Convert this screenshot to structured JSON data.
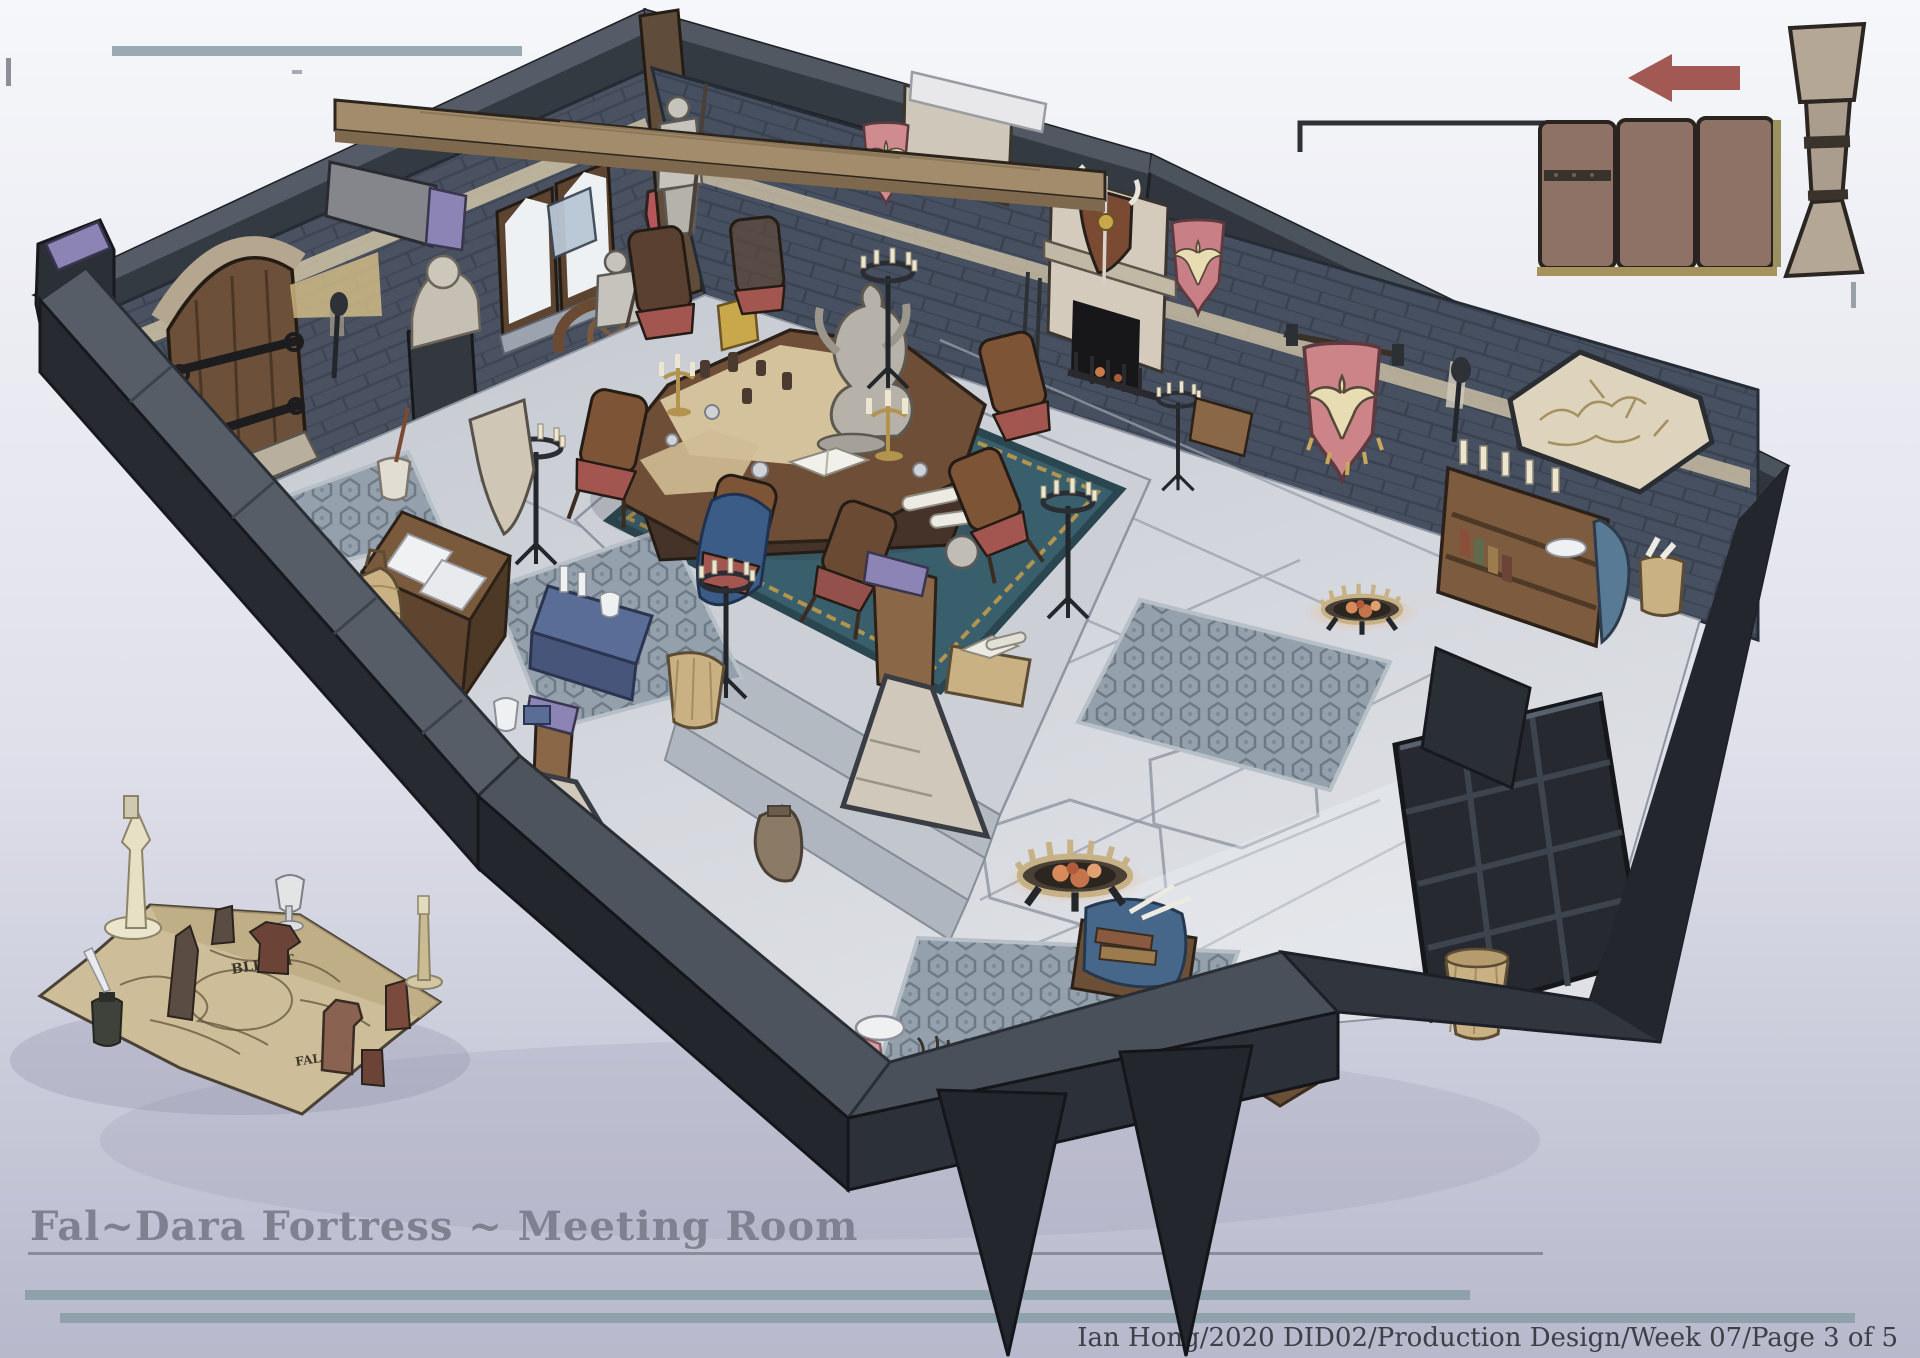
{
  "artwork": {
    "title": "Fal~Dara Fortress ~ Meeting Room",
    "credit": "Ian Hong/2020 DID02/Production Design/Week 07/Page 3 of 5",
    "map_labels": {
      "region": "BLIGHT",
      "fortress": "FAL"
    }
  },
  "palette": {
    "background_top": "#f6f7fa",
    "background_bottom": "#b7b9cc",
    "accent_teal": "#8fa2ac",
    "title_grey": "#7f8090",
    "credit_grey": "#3d4046",
    "outer_wall_dark": "#2c3037",
    "wall_top_face": "#596068",
    "stone_wall": "#4a5261",
    "floor_stone": "#c9ccd3",
    "wood_brown": "#7b5b40",
    "beam_tan": "#a38c6b",
    "banner_pink": "#cf8b90",
    "banner_bird_cream": "#e8ddb2",
    "rug_teal": "#3a5f6c",
    "rug_grey": "#94a0ac",
    "cushion_red": "#a3564f",
    "ember_orange": "#d98a5a",
    "purple_cap": "#8d84b6",
    "parchment": "#cdbd98",
    "fireplace_stone": "#d4cbbc",
    "armor_grey": "#c6c3bd",
    "callout_arrow_red": "#a25953",
    "callout_panel_brown": "#8d7265",
    "callout_pillar_tan": "#b4a796"
  }
}
